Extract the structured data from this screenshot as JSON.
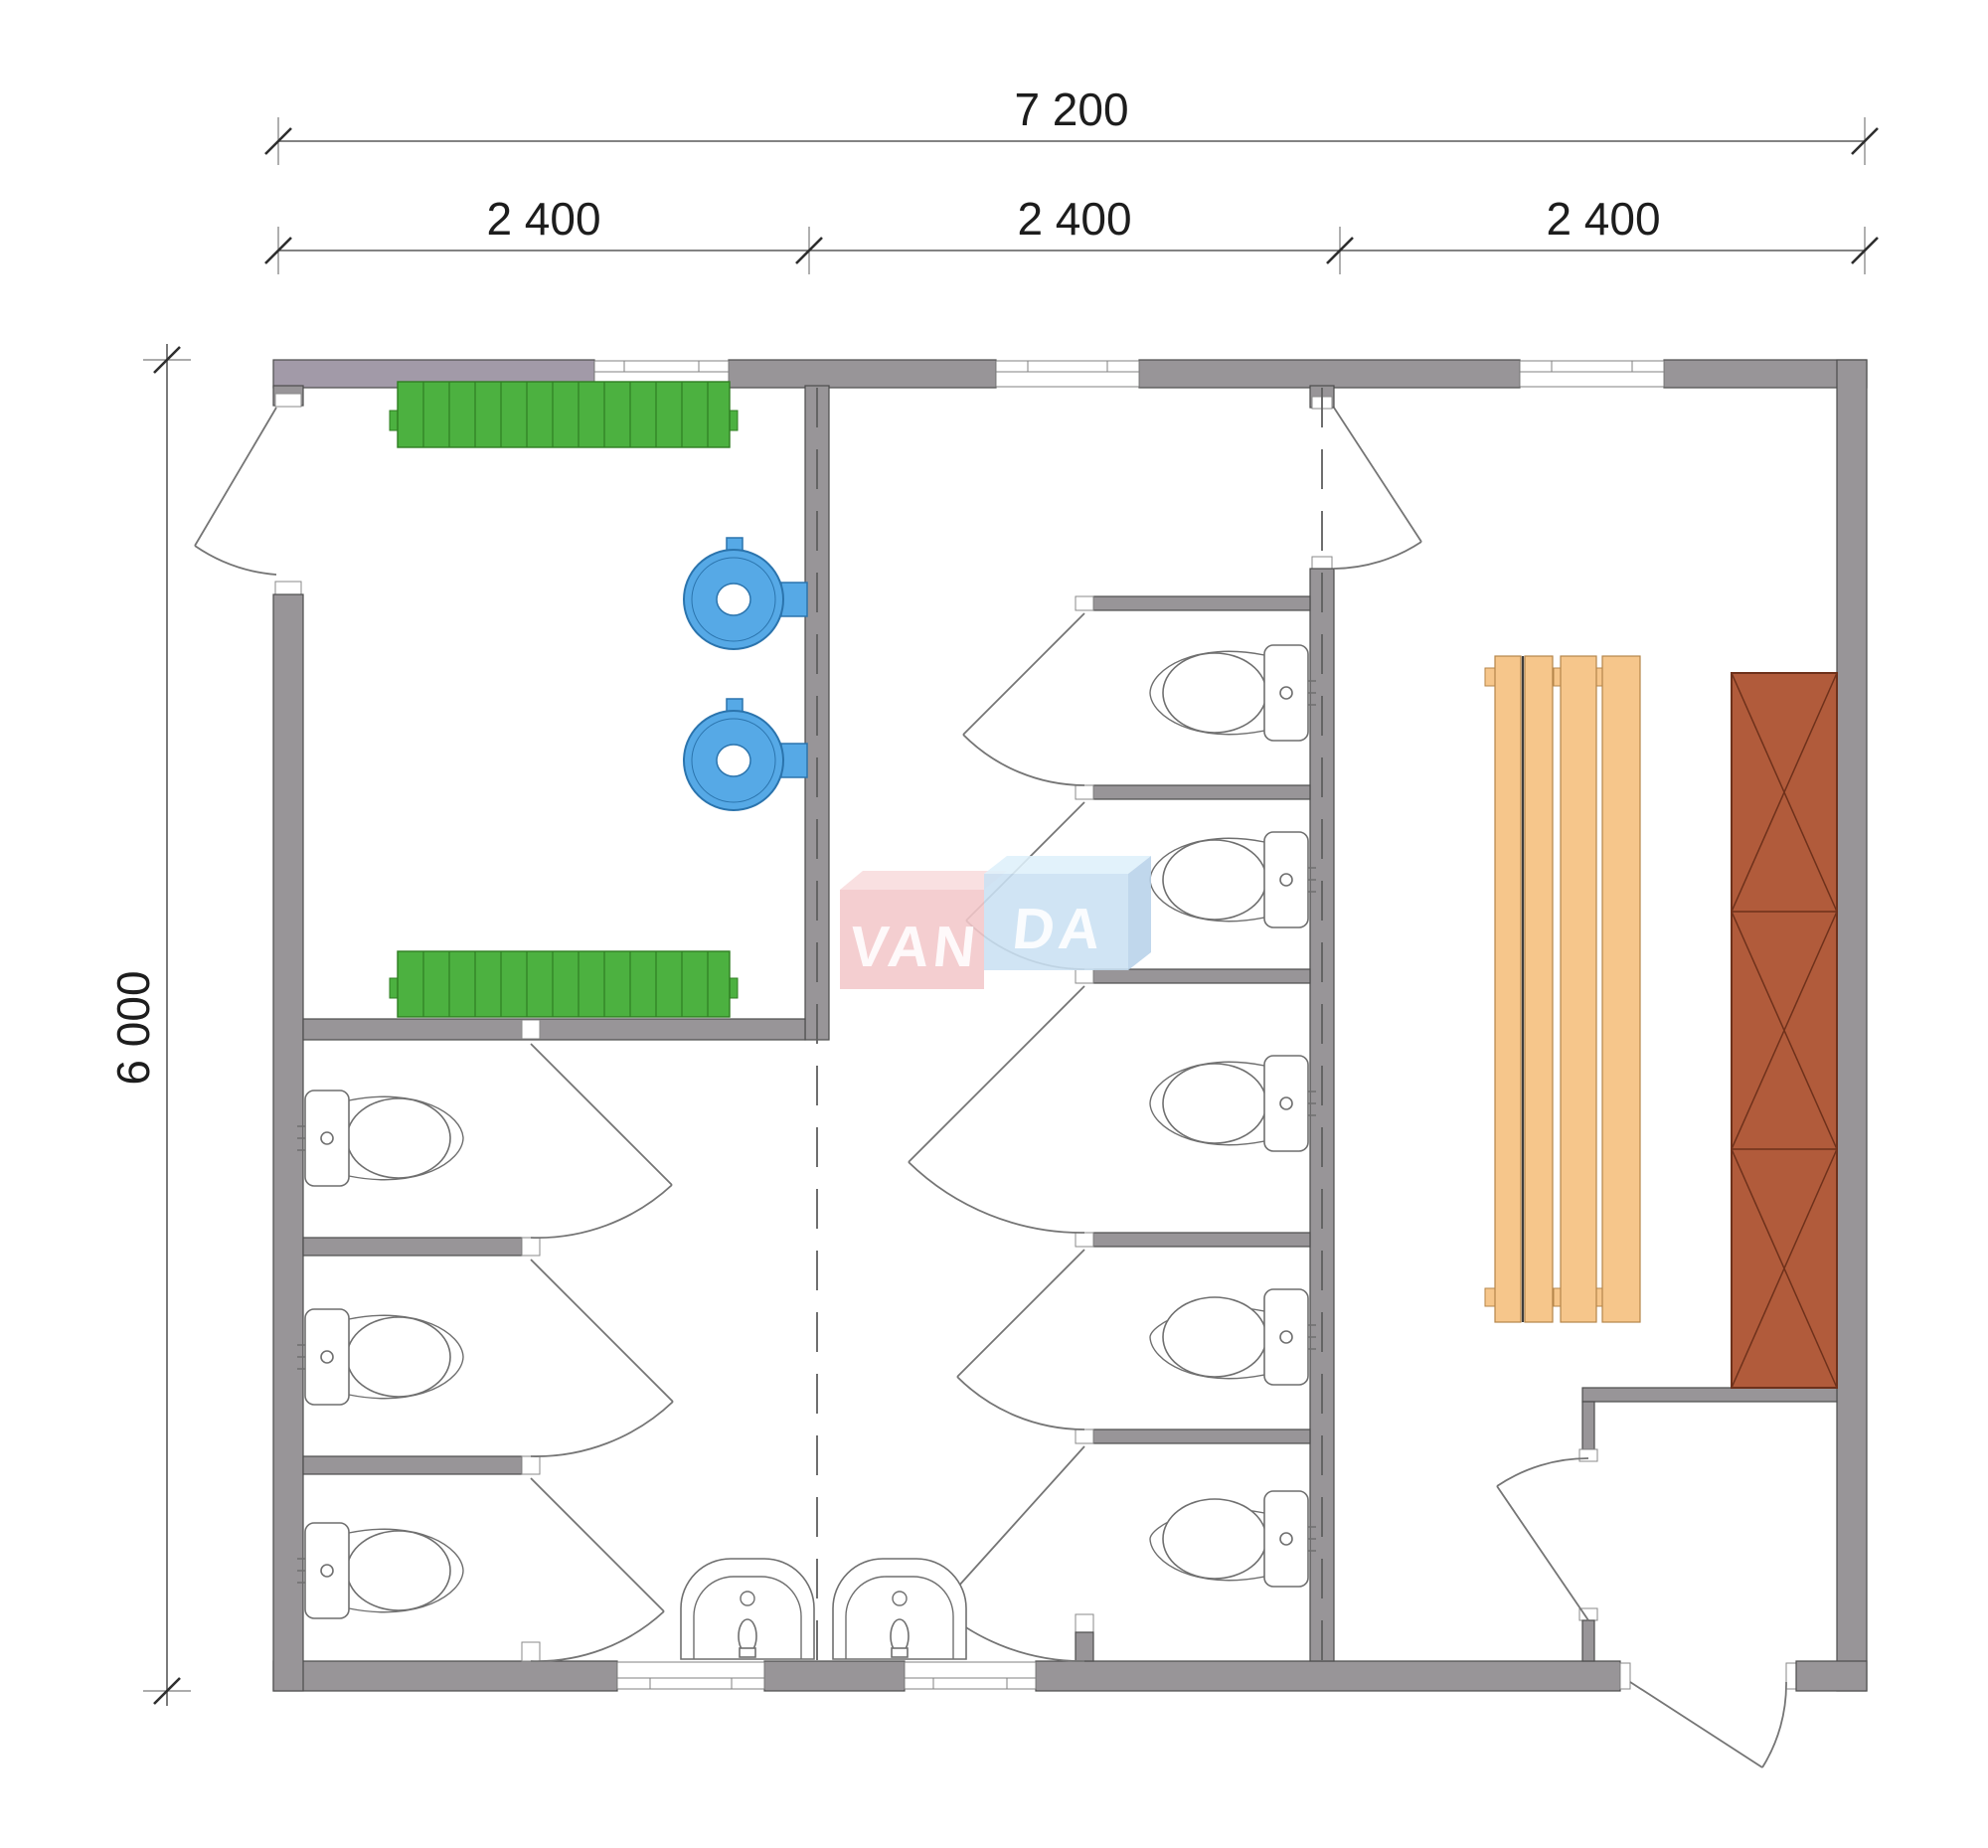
{
  "document": {
    "kind": "floor-plan-drawing",
    "background": "#ffffff"
  },
  "dimensions": {
    "total_width_label": "7 200",
    "segment_labels": [
      "2 400",
      "2 400",
      "2 400"
    ],
    "total_height_label": "6 000"
  },
  "watermark": {
    "left": "VAN",
    "right": "DA",
    "full": "VANDA"
  },
  "palette": {
    "wall_gray": "#989598",
    "wall_mauve": "#a29aa8",
    "bench_green": "#4cb140",
    "bench_green_line": "#2f7d22",
    "heater_blue": "#56a9e6",
    "heater_blue_dark": "#2b74ad",
    "bench_wood": "#f6c68b",
    "bench_wood_line": "#b5854a",
    "cabinet_brown": "#b15b3b",
    "cabinet_brown_line": "#6e311b",
    "logo_pink": "#f3c7ca",
    "logo_pink_top": "#f8dcdd",
    "logo_blue": "#c9e0f2",
    "logo_blue_top": "#def0fa",
    "logo_blue_side": "#b7d2e9",
    "drawing_line": "#757575"
  },
  "fixtures": {
    "toilets_left_block": 3,
    "toilets_middle_block": 5,
    "sinks": 2,
    "water_heaters": 2,
    "green_benches": 2,
    "wood_bench_planks": 4,
    "cabinet_sections": 3,
    "windows": 5,
    "doors": 12
  }
}
